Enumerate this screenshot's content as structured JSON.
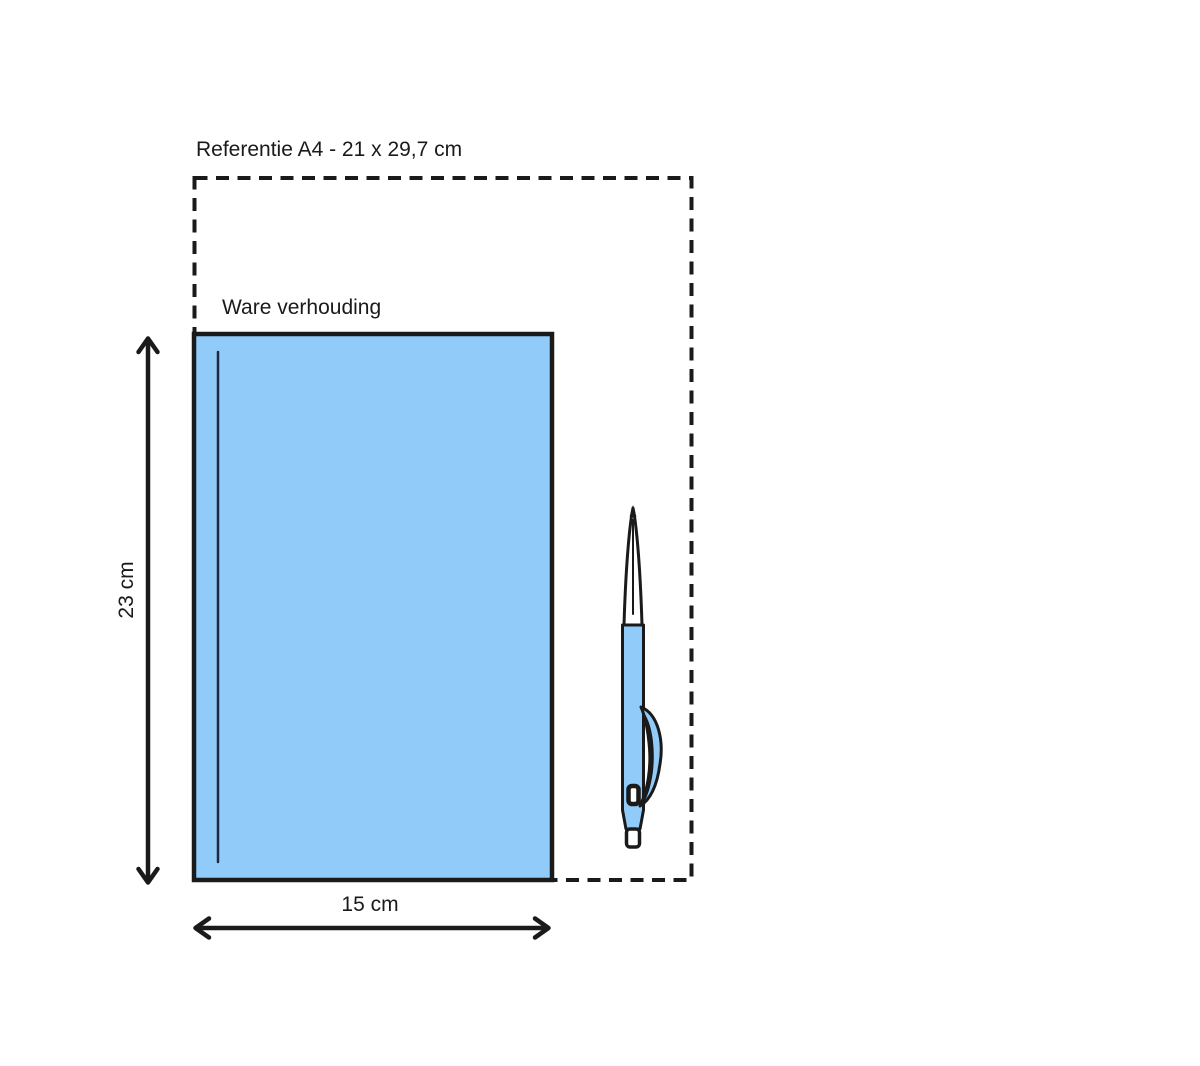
{
  "diagram": {
    "reference_label": "Referentie A4 - 21 x 29,7 cm",
    "scale_label": "Ware verhouding",
    "height_label": "23 cm",
    "width_label": "15 cm"
  },
  "reference": {
    "format": "A4",
    "width_cm": 21,
    "height_cm": 29.7
  },
  "product": {
    "width_cm": 15,
    "height_cm": 23
  },
  "colors": {
    "ink": "#1a1a1a",
    "book_fill": "#90cbfa",
    "pen_fill": "#90cbfa",
    "spine_line": "#1c2b3f",
    "bg": "#ffffff"
  }
}
